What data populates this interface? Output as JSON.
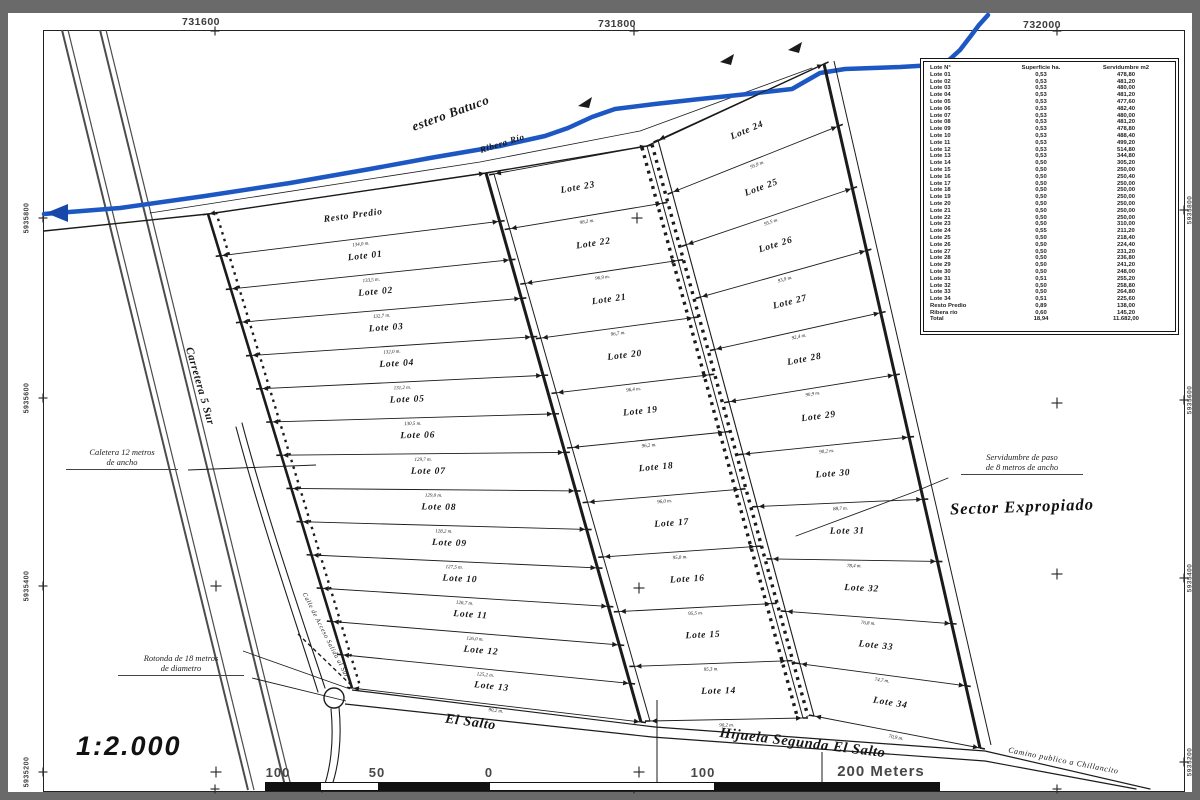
{
  "frame": {
    "top_coords": [
      "731600",
      "731800",
      "732000"
    ],
    "left_coords": [
      "5935800",
      "5935600",
      "5935400",
      "5935200"
    ],
    "right_coords": [
      "5935800",
      "5935600",
      "5935400",
      "5935200"
    ]
  },
  "map_labels": [
    {
      "key": "river",
      "text": "estero Batuco"
    },
    {
      "key": "ribera",
      "text": "Ribera Río"
    },
    {
      "key": "carretera",
      "text": "Carretera 5 Sur"
    },
    {
      "key": "calle",
      "text": "Calle de Acceso Salida al Sur"
    },
    {
      "key": "elsalto",
      "text": "El Salto"
    },
    {
      "key": "hijuela",
      "text": "Hijuela Segunda El Salto"
    },
    {
      "key": "camino",
      "text": "Camino publico a Chillancito"
    }
  ],
  "annotations": {
    "caletera": {
      "line1": "Caletera 12 metros",
      "line2": "de ancho"
    },
    "servidumbre": {
      "line1": "Servidumbre de paso",
      "line2": "de 8 metros de ancho"
    },
    "rotonda": {
      "line1": "Rotonda de 18 metros",
      "line2": "de diametro"
    },
    "sector": "Sector Expropiado"
  },
  "columns": [
    {
      "lots": [
        "Resto Predio",
        "Lote 01",
        "Lote 02",
        "Lote 03",
        "Lote 04",
        "Lote 05",
        "Lote 06",
        "Lote 07",
        "Lote 08",
        "Lote 09",
        "Lote 10",
        "Lote 11",
        "Lote 12",
        "Lote 13"
      ],
      "dims": [
        "134,0 m.",
        "133,5 m.",
        "132,7 m.",
        "132,0 m.",
        "131,2 m.",
        "130,5 m.",
        "129,7 m.",
        "129,0 m.",
        "128,2 m.",
        "127,5 m.",
        "126,7 m.",
        "126,0 m.",
        "125,2 m.",
        "90,2 m."
      ]
    },
    {
      "lots": [
        "Lote 23",
        "Lote 22",
        "Lote 21",
        "Lote 20",
        "Lote 19",
        "Lote 18",
        "Lote 17",
        "Lote 16",
        "Lote 15",
        "Lote 14"
      ],
      "dims": [
        "98,2 m.",
        "96,9 m.",
        "96,7 m.",
        "96,4 m.",
        "96,2 m.",
        "96,0 m.",
        "95,8 m.",
        "95,5 m.",
        "95,3 m.",
        "90,2 m."
      ]
    },
    {
      "lots": [
        "Lote 24",
        "Lote 25",
        "Lote 26",
        "Lote 27",
        "Lote 28",
        "Lote 29",
        "Lote 30",
        "Lote 31",
        "Lote 32",
        "Lote 33",
        "Lote 34"
      ],
      "dims": [
        "95,9 m.",
        "95,5 m.",
        "93,9 m.",
        "92,4 m.",
        "90,9 m.",
        "90,2 m.",
        "88,7 m.",
        "78,4 m.",
        "76,8 m.",
        "74,7 m.",
        "70,9 m."
      ]
    }
  ],
  "legend_table": {
    "headers": [
      "Lote N°",
      "Superficie ha.",
      "Servidumbre m2"
    ],
    "rows": [
      [
        "Lote 01",
        "0,53",
        "478,80"
      ],
      [
        "Lote 02",
        "0,53",
        "481,20"
      ],
      [
        "Lote 03",
        "0,53",
        "480,00"
      ],
      [
        "Lote 04",
        "0,53",
        "481,20"
      ],
      [
        "Lote 05",
        "0,53",
        "477,60"
      ],
      [
        "Lote 06",
        "0,53",
        "482,40"
      ],
      [
        "Lote 07",
        "0,53",
        "480,00"
      ],
      [
        "Lote 08",
        "0,53",
        "481,20"
      ],
      [
        "Lote 09",
        "0,53",
        "478,80"
      ],
      [
        "Lote 10",
        "0,53",
        "488,40"
      ],
      [
        "Lote 11",
        "0,53",
        "499,20"
      ],
      [
        "Lote 12",
        "0,53",
        "514,80"
      ],
      [
        "Lote 13",
        "0,53",
        "344,80"
      ],
      [
        "Lote 14",
        "0,50",
        "305,20"
      ],
      [
        "Lote 15",
        "0,50",
        "250,00"
      ],
      [
        "Lote 16",
        "0,50",
        "250,40"
      ],
      [
        "Lote 17",
        "0,50",
        "250,00"
      ],
      [
        "Lote 18",
        "0,50",
        "250,00"
      ],
      [
        "Lote 19",
        "0,50",
        "250,00"
      ],
      [
        "Lote 20",
        "0,50",
        "250,00"
      ],
      [
        "Lote 21",
        "0,50",
        "250,00"
      ],
      [
        "Lote 22",
        "0,50",
        "250,00"
      ],
      [
        "Lote 23",
        "0,50",
        "310,00"
      ],
      [
        "Lote 24",
        "0,55",
        "211,20"
      ],
      [
        "Lote 25",
        "0,50",
        "218,40"
      ],
      [
        "Lote 26",
        "0,50",
        "224,40"
      ],
      [
        "Lote 27",
        "0,50",
        "231,20"
      ],
      [
        "Lote 28",
        "0,50",
        "236,80"
      ],
      [
        "Lote 29",
        "0,50",
        "241,20"
      ],
      [
        "Lote 30",
        "0,50",
        "248,00"
      ],
      [
        "Lote 31",
        "0,51",
        "255,20"
      ],
      [
        "Lote 32",
        "0,50",
        "258,80"
      ],
      [
        "Lote 33",
        "0,50",
        "264,80"
      ],
      [
        "Lote 34",
        "0,51",
        "225,60"
      ],
      [
        "Resto Predio",
        "0,89",
        "138,00"
      ],
      [
        "Ribera río",
        "0,60",
        "145,20"
      ],
      [
        "Total",
        "18,94",
        "11.682,00"
      ]
    ]
  },
  "scale": {
    "text": "1:2.000",
    "bar_labels": [
      "100",
      "50",
      "0",
      "100",
      "200 Meters"
    ]
  },
  "colors": {
    "river_blue": "#1c57c4",
    "river_arrow_blue": "#1747a8",
    "ink": "#1b1b1b",
    "scan_gray": "#6a6a6a"
  }
}
